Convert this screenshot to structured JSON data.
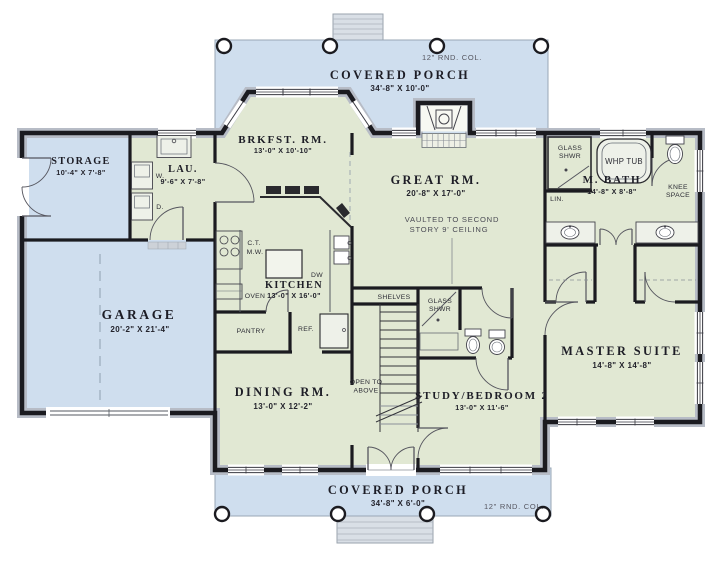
{
  "palette": {
    "porch_fill": "#cfdeee",
    "room_fill": "#e1e8d3",
    "garage_fill": "#cfdeee",
    "wall": "#1b1b20",
    "steps_fill": "#d9dfe6"
  },
  "porches": {
    "top": {
      "name": "COVERED PORCH",
      "dims": "34'-8\" X 10'-0\""
    },
    "bottom": {
      "name": "COVERED PORCH",
      "dims": "34'-8\" X 6'-0\""
    },
    "column_note": "12\" RND. COL."
  },
  "rooms": {
    "storage": {
      "name": "STORAGE",
      "dims": "10'-4\" X 7'-8\""
    },
    "laundry": {
      "name": "LAU.",
      "dims": "9'-6\" X 7'-8\""
    },
    "garage": {
      "name": "GARAGE",
      "dims": "20'-2\" X 21'-4\""
    },
    "breakfast": {
      "name": "BRKFST. RM.",
      "dims": "13'-0\" X 10'-10\""
    },
    "kitchen": {
      "name": "KITCHEN",
      "dims": "13'-0\" X 16'-0\""
    },
    "dining": {
      "name": "DINING RM.",
      "dims": "13'-0\" X 12'-2\""
    },
    "great": {
      "name": "GREAT RM.",
      "dims": "20'-8\" X 17'-0\"",
      "note_line1": "VAULTED TO SECOND",
      "note_line2": "STORY 9' CEILING"
    },
    "master_bath": {
      "name": "M. BATH",
      "dims": "14'-8\" X 8'-8\""
    },
    "master": {
      "name": "MASTER SUITE",
      "dims": "14'-8\" X 14'-8\""
    },
    "study": {
      "name": "STUDY/BEDROOM 2",
      "dims": "13'-0\" X 11'-6\""
    }
  },
  "fixtures": {
    "washer": "W.",
    "dryer": "D.",
    "cooktop": "C.T.",
    "microwave": "M.W.",
    "oven": "OVEN",
    "pantry": "PANTRY",
    "refrigerator": "REF.",
    "dishwasher": "DW",
    "shelves": "SHELVES",
    "open_to_above_1": "OPEN TO",
    "open_to_above_2": "ABOVE",
    "glass_shower_1": "GLASS",
    "glass_shower_2": "SHWR",
    "whirlpool_tub": "WHP TUB",
    "linen": "LIN.",
    "knee_space_1": "KNEE",
    "knee_space_2": "SPACE"
  }
}
